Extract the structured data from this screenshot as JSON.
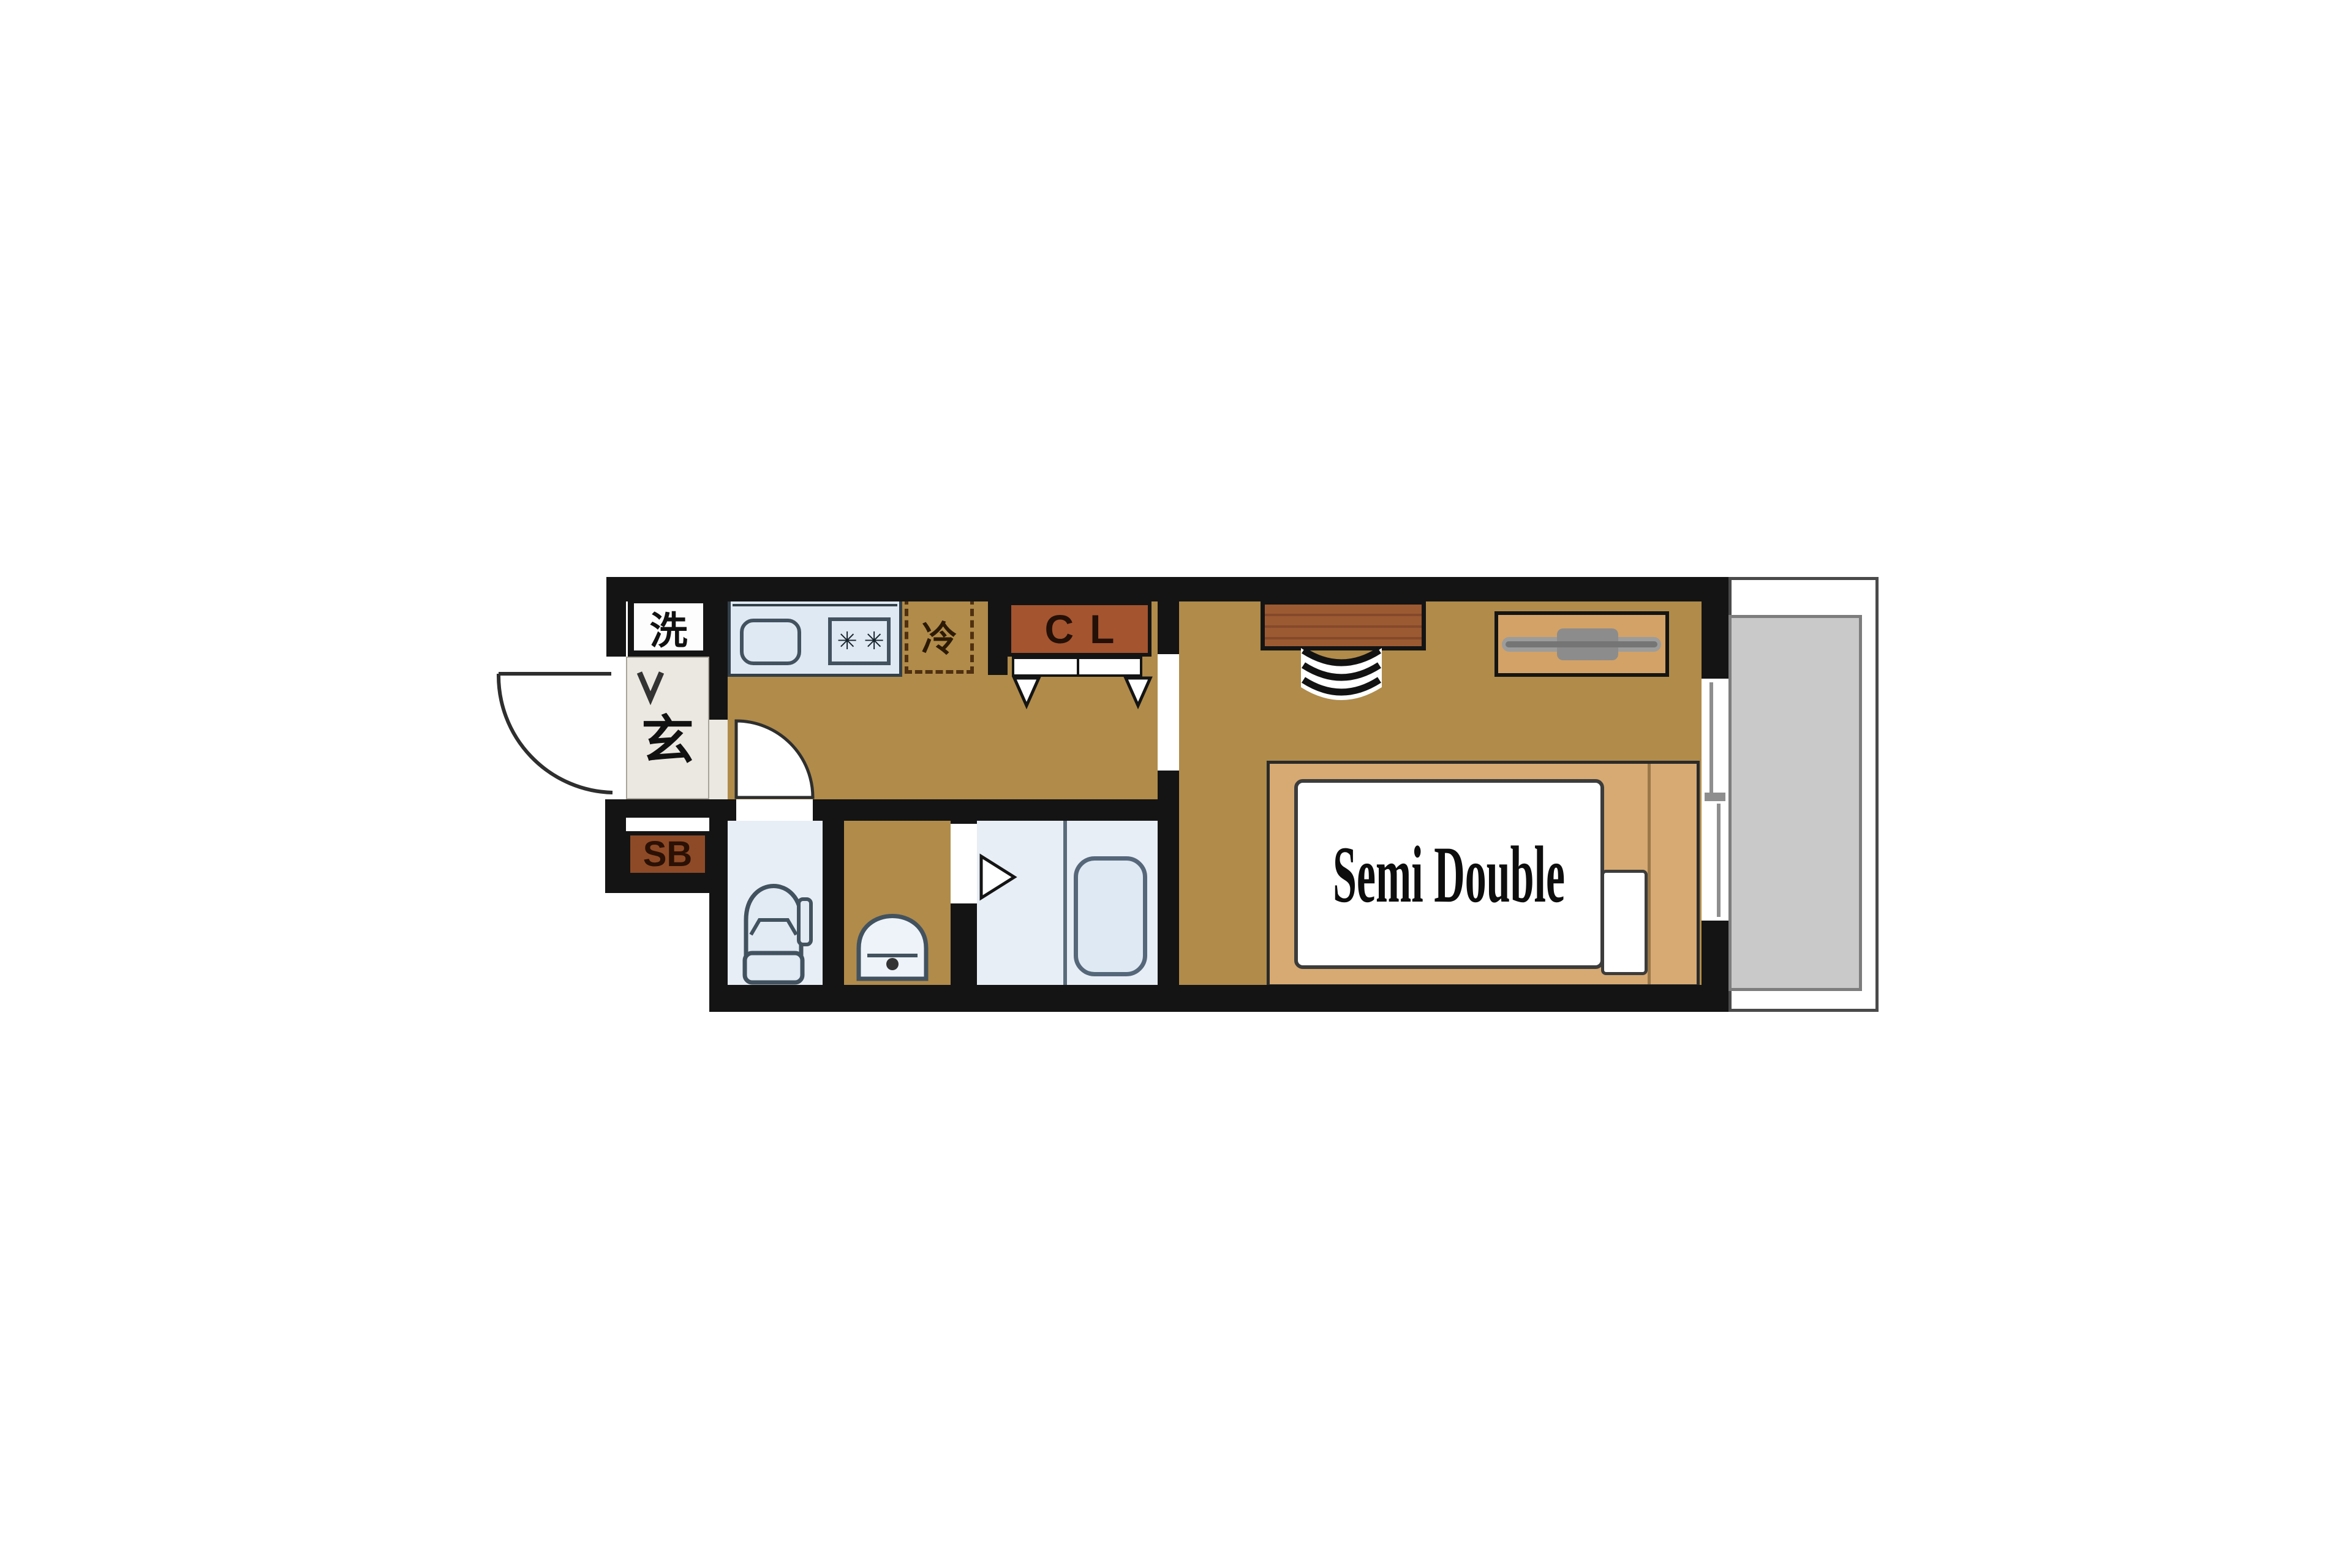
{
  "plan": {
    "type": "apartment-floor-plan",
    "labels": {
      "washer": "洗",
      "entrance": "玄",
      "shoe_box": "SB",
      "closet": "CL",
      "refrigerator": "冷",
      "bed_size": "Semi Double"
    },
    "icons": {
      "burner": "✳"
    },
    "palette": {
      "wall": "#141414",
      "floor_tan": "#b08b4a",
      "room_blue": "#e8eef6",
      "fixture_blue_fill": "#dfe9f4",
      "fixture_blue_stroke": "#42525f",
      "closet_brown": "#a4542f",
      "shoe_box_brown": "#8e4a26",
      "desk_brown": "#9c5a32",
      "bed_frame_tan": "#d6aa72",
      "tv_board_tan": "#d3a266",
      "genkan_floor": "#ebe8e1",
      "balcony_gray": "#c9c9c9",
      "mattress_white": "#ffffff"
    }
  }
}
